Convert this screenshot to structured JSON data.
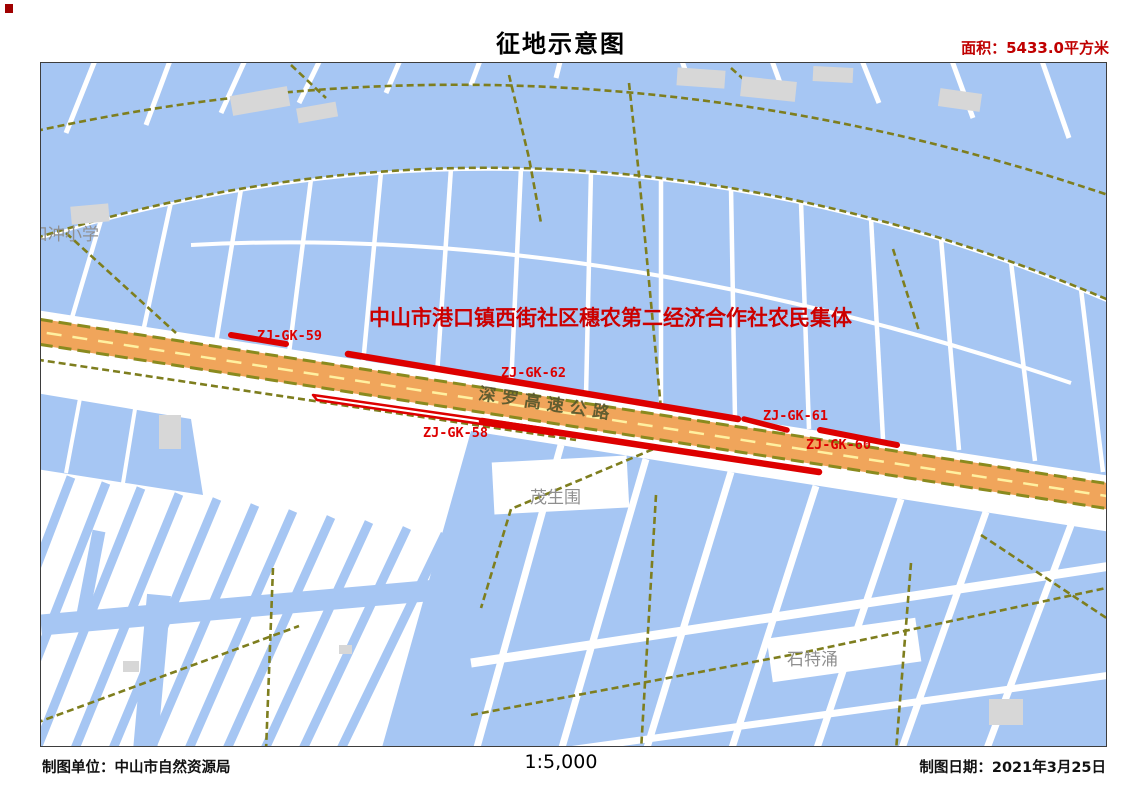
{
  "page": {
    "title": "征地示意图",
    "area_note": "面积：5433.0平方米"
  },
  "footer": {
    "producer": "制图单位：中山市自然资源局",
    "scale": "1:5,000",
    "date": "制图日期：2021年3月25日"
  },
  "map": {
    "owner_collective": "中山市港口镇西街社区穗农第二经济合作社农民集体",
    "highway_name": "深罗高速公路",
    "parcel_labels": [
      "ZJ-GK-58",
      "ZJ-GK-59",
      "ZJ-GK-60",
      "ZJ-GK-61",
      "ZJ-GK-62"
    ],
    "place_labels": [
      "口冲小学",
      "茂生围",
      "石特涌"
    ],
    "colors": {
      "water": "#A6C6F3",
      "levee_road": "#7E7E1E",
      "highway_fill": "#F0A55B",
      "highway_center_dash": "#FFF0A0",
      "annotation_red": "#DD0000",
      "area_text_red": "#C00000",
      "building_gray": "#D7D7D7",
      "place_label_gray": "#8F8F8F"
    }
  }
}
